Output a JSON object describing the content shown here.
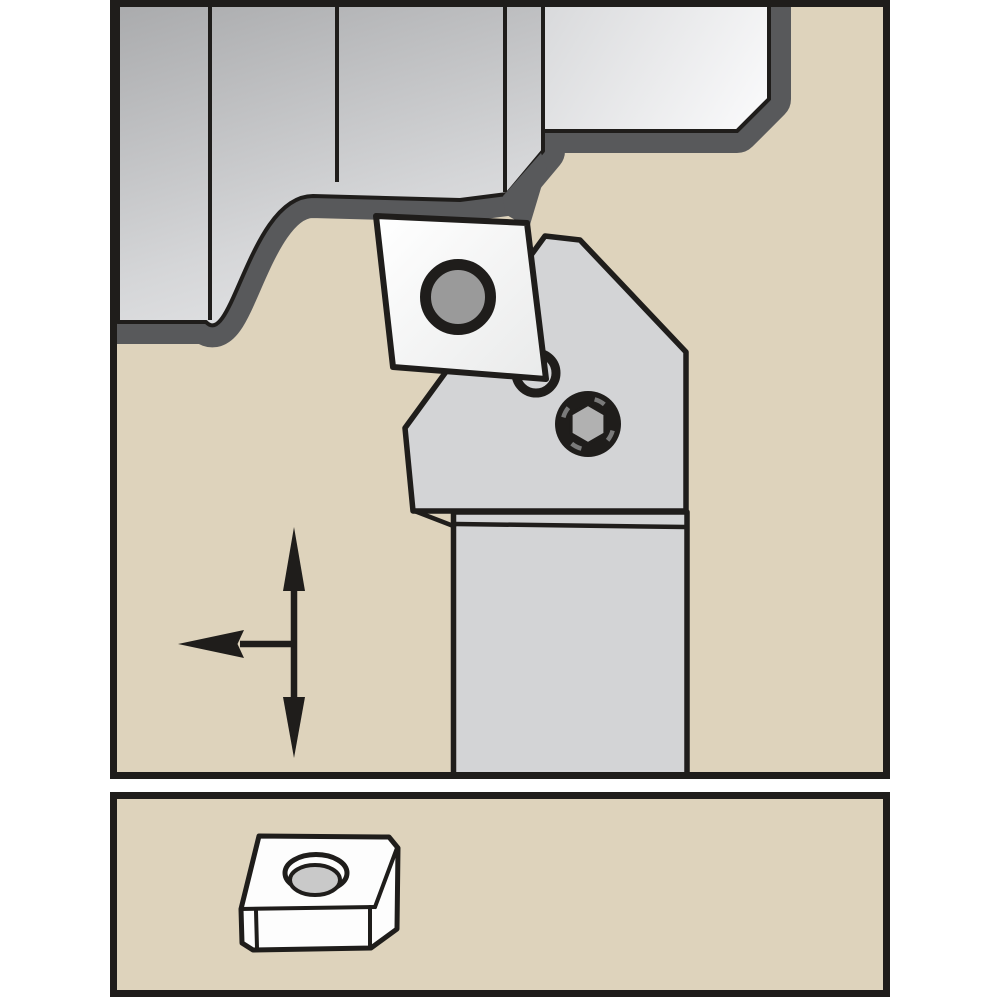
{
  "document": {
    "title": "Lathe turning toolholder with indexable insert — operation diagram",
    "description": "Technical illustration: a turning toolholder cutting a stepped workpiece, feed-direction arrows, and a detail view of the indexable insert."
  },
  "colors": {
    "page_bg": "#ffffff",
    "panel_bg": "#ded3bc",
    "ink": "#1f1d1b",
    "band": "#58595b",
    "metal_top": "#a9aaac",
    "metal_mid": "#d5d6d8",
    "metal_bottom": "#f8f8f9",
    "block_light_start": "#d8d9db",
    "block_light_end": "#fdfdfe",
    "tool_gray": "#d3d4d6",
    "insert_face_start": "#ffffff",
    "insert_face_end": "#e9eaea",
    "insert_hole_gray": "#9a9a9a",
    "screw_black": "#1f1d1b",
    "screw_hex_gray": "#b1b1b1",
    "screw_glint_gray": "#7a7a7a",
    "spare_insert_white": "#fdfdfd",
    "spare_hole_gray": "#c9c9c9"
  },
  "panels": {
    "main": {
      "label": "Turning operation — toolholder engaged with stepped workpiece"
    },
    "detail": {
      "label": "Indexable insert — detail view"
    }
  },
  "components": {
    "workpiece": {
      "label": "Workpiece (stepped turned part)"
    },
    "workpiece_step_block": {
      "label": "Workpiece shoulder block (chamfered)"
    },
    "toolholder_head": {
      "label": "Toolholder head"
    },
    "toolholder_shank": {
      "label": "Toolholder shank"
    },
    "insert": {
      "label": "Indexable cutting insert"
    },
    "insert_hole": {
      "label": "Insert clamping hole"
    },
    "pin_hole": {
      "label": "Locating pin under insert"
    },
    "clamp_screw": {
      "label": "Hex-socket clamp screw"
    },
    "feed_arrows": {
      "label": "Feed direction arrows (longitudinal / facing)"
    },
    "spare_insert": {
      "label": "Indexable insert, 3-D detail view"
    },
    "spare_insert_hole": {
      "label": "Insert center hole (countersunk)"
    }
  }
}
